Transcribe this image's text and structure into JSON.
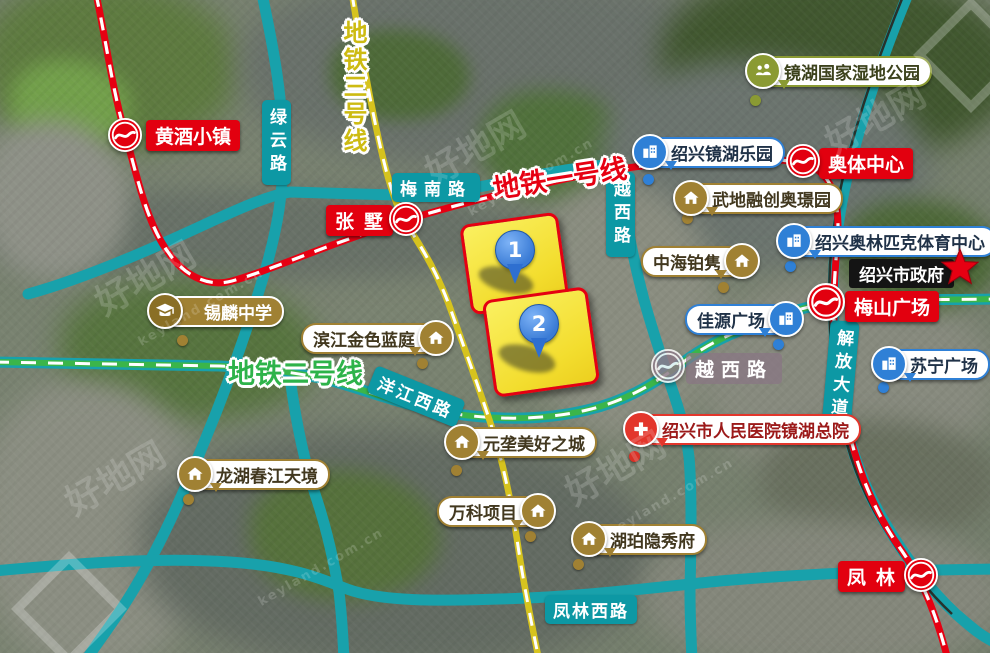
{
  "map": {
    "watermark": {
      "brand": "好地网",
      "domain": "keyland.com.cn"
    },
    "colors": {
      "metro_line1_red": "#e60012",
      "metro_line2_green": "#3bb54a",
      "metro_line3_yellow": "#d6c31e",
      "road_teal": "#17a2ac",
      "road_label_teal": "#0d98a4",
      "estate_gold": "#a08133",
      "poi_blue": "#2f80d6",
      "park_olive": "#8a9a33",
      "hospital_red": "#e3362c",
      "parcel_fill_yellow": "#f5e13a",
      "parcel_border_red": "#e50012",
      "pin_blue": "#3a7bd5",
      "station_red": "#e2000f",
      "government_black": "#141414",
      "star_red": "#e60012"
    },
    "metro_lines": [
      {
        "id": "line1",
        "label": "地铁一号线"
      },
      {
        "id": "line2",
        "label": "地铁二号线"
      },
      {
        "id": "line3",
        "label": "地铁三号线"
      }
    ],
    "stations": [
      {
        "id": "huangjiu",
        "name": "黄酒小镇"
      },
      {
        "id": "zhangshu",
        "name": "张墅"
      },
      {
        "id": "aoti",
        "name": "奥体中心"
      },
      {
        "id": "meishan",
        "name": "梅山广场"
      },
      {
        "id": "yuexilu",
        "name": "越西路"
      },
      {
        "id": "fenglin",
        "name": "凤林"
      }
    ],
    "roads": [
      {
        "id": "lvyun",
        "name": "绿云路"
      },
      {
        "id": "meinan",
        "name": "梅南路"
      },
      {
        "id": "yuexi",
        "name": "越西路"
      },
      {
        "id": "jiefang",
        "name": "解放大道"
      },
      {
        "id": "yangjiang",
        "name": "洋江西路"
      },
      {
        "id": "fenglinxi",
        "name": "凤林西路"
      }
    ],
    "parcels": [
      {
        "number": "1"
      },
      {
        "number": "2"
      }
    ],
    "gold_pois": [
      {
        "name": "锡麟中学"
      },
      {
        "name": "滨江金色蓝庭"
      },
      {
        "name": "武地融创奥璟园"
      },
      {
        "name": "中海铂隽"
      },
      {
        "name": "元垄美好之城"
      },
      {
        "name": "万科项目"
      },
      {
        "name": "湖珀隐秀府"
      },
      {
        "name": "龙湖春江天境"
      }
    ],
    "blue_pois": [
      {
        "name": "绍兴镜湖乐园"
      },
      {
        "name": "绍兴奥林匹克体育中心"
      },
      {
        "name": "佳源广场"
      },
      {
        "name": "苏宁广场"
      }
    ],
    "park_poi": {
      "name": "镜湖国家湿地公园"
    },
    "hospital_poi": {
      "name": "绍兴市人民医院镜湖总院"
    },
    "government_poi": {
      "name": "绍兴市政府"
    }
  }
}
